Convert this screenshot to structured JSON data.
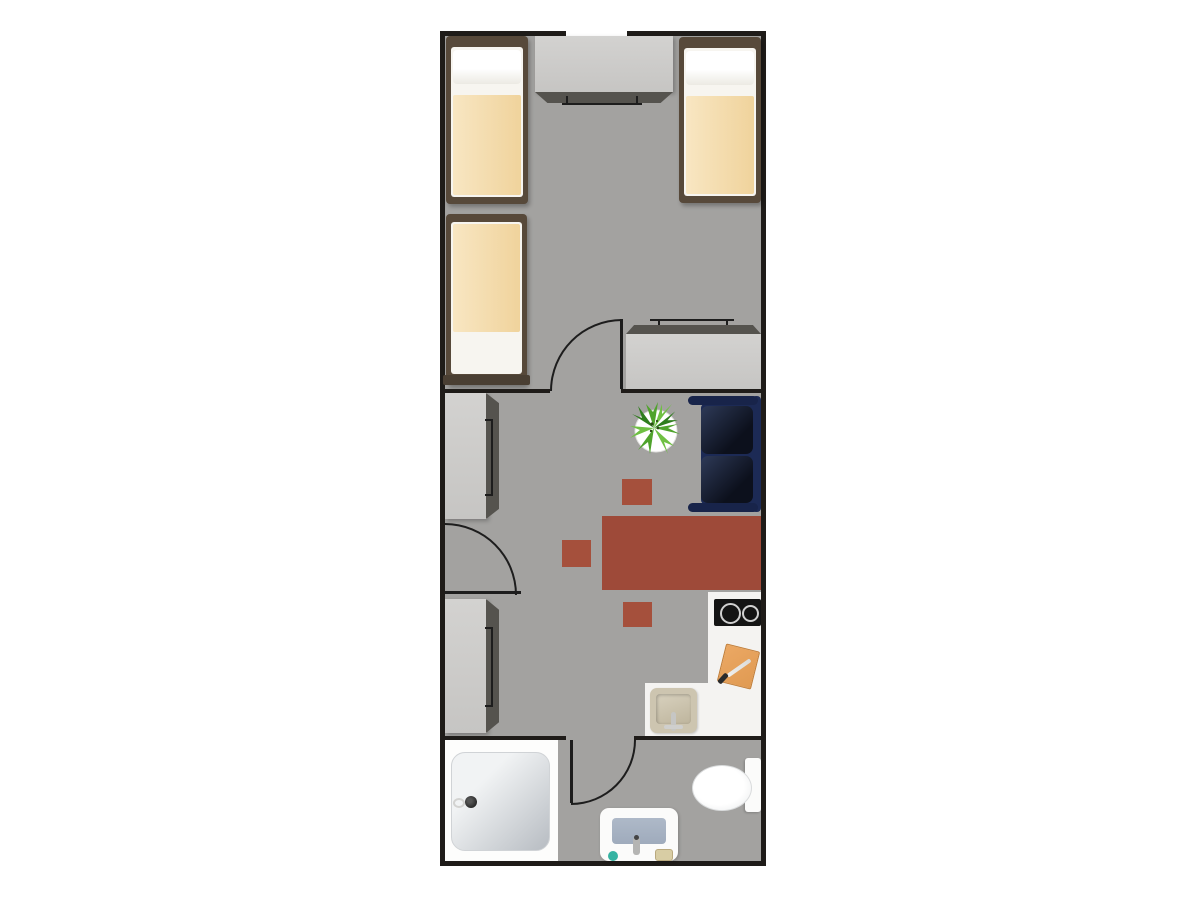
{
  "scene": {
    "type": "floor-plan",
    "view": "top-down",
    "rooms": [
      {
        "name": "bedroom",
        "furniture": [
          "single-bed-left",
          "single-bed-right",
          "single-bed-middle",
          "wardrobe-top",
          "dresser"
        ]
      },
      {
        "name": "living-kitchen",
        "furniture": [
          "cabinet-upper",
          "cabinet-lower",
          "sofa",
          "potted-plant",
          "dining-table",
          "stool-1",
          "stool-2",
          "stool-3",
          "kitchen-counter",
          "cooktop",
          "cutting-board",
          "kitchen-sink"
        ]
      },
      {
        "name": "bathroom",
        "furniture": [
          "shower-tray",
          "toilet",
          "washbasin-vanity"
        ]
      }
    ],
    "doors_count": 3,
    "windows_count": 1
  },
  "colors": {
    "background": "#ffffff",
    "wall": "#1f1c19",
    "floor": "#a3a2a0",
    "window": "#c9c7c4",
    "bed_frame": "#57493a",
    "mattress": "#f7f5f0",
    "blanket": "#f0d39c",
    "cabinet": "#cccbc9",
    "cabinet_side": "#55534e",
    "sofa_frame": "#1c2a55",
    "sofa_seat": "#0c101c",
    "table": "#9e4a39",
    "stool": "#a5503c",
    "counter": "#f4f3f1",
    "cooktop": "#141414",
    "cutting_board": "#e09a52",
    "sink": "#cdc5b0",
    "shower_area": "#fdfdfc",
    "shower_tray": "#c4c9cf",
    "toilet": "#fbfbfa",
    "vanity_basin": "#9fabbc",
    "soap_teal": "#35b3a2",
    "plant_leaf": "#4fa32c",
    "door_line": "#1d1d1d"
  }
}
